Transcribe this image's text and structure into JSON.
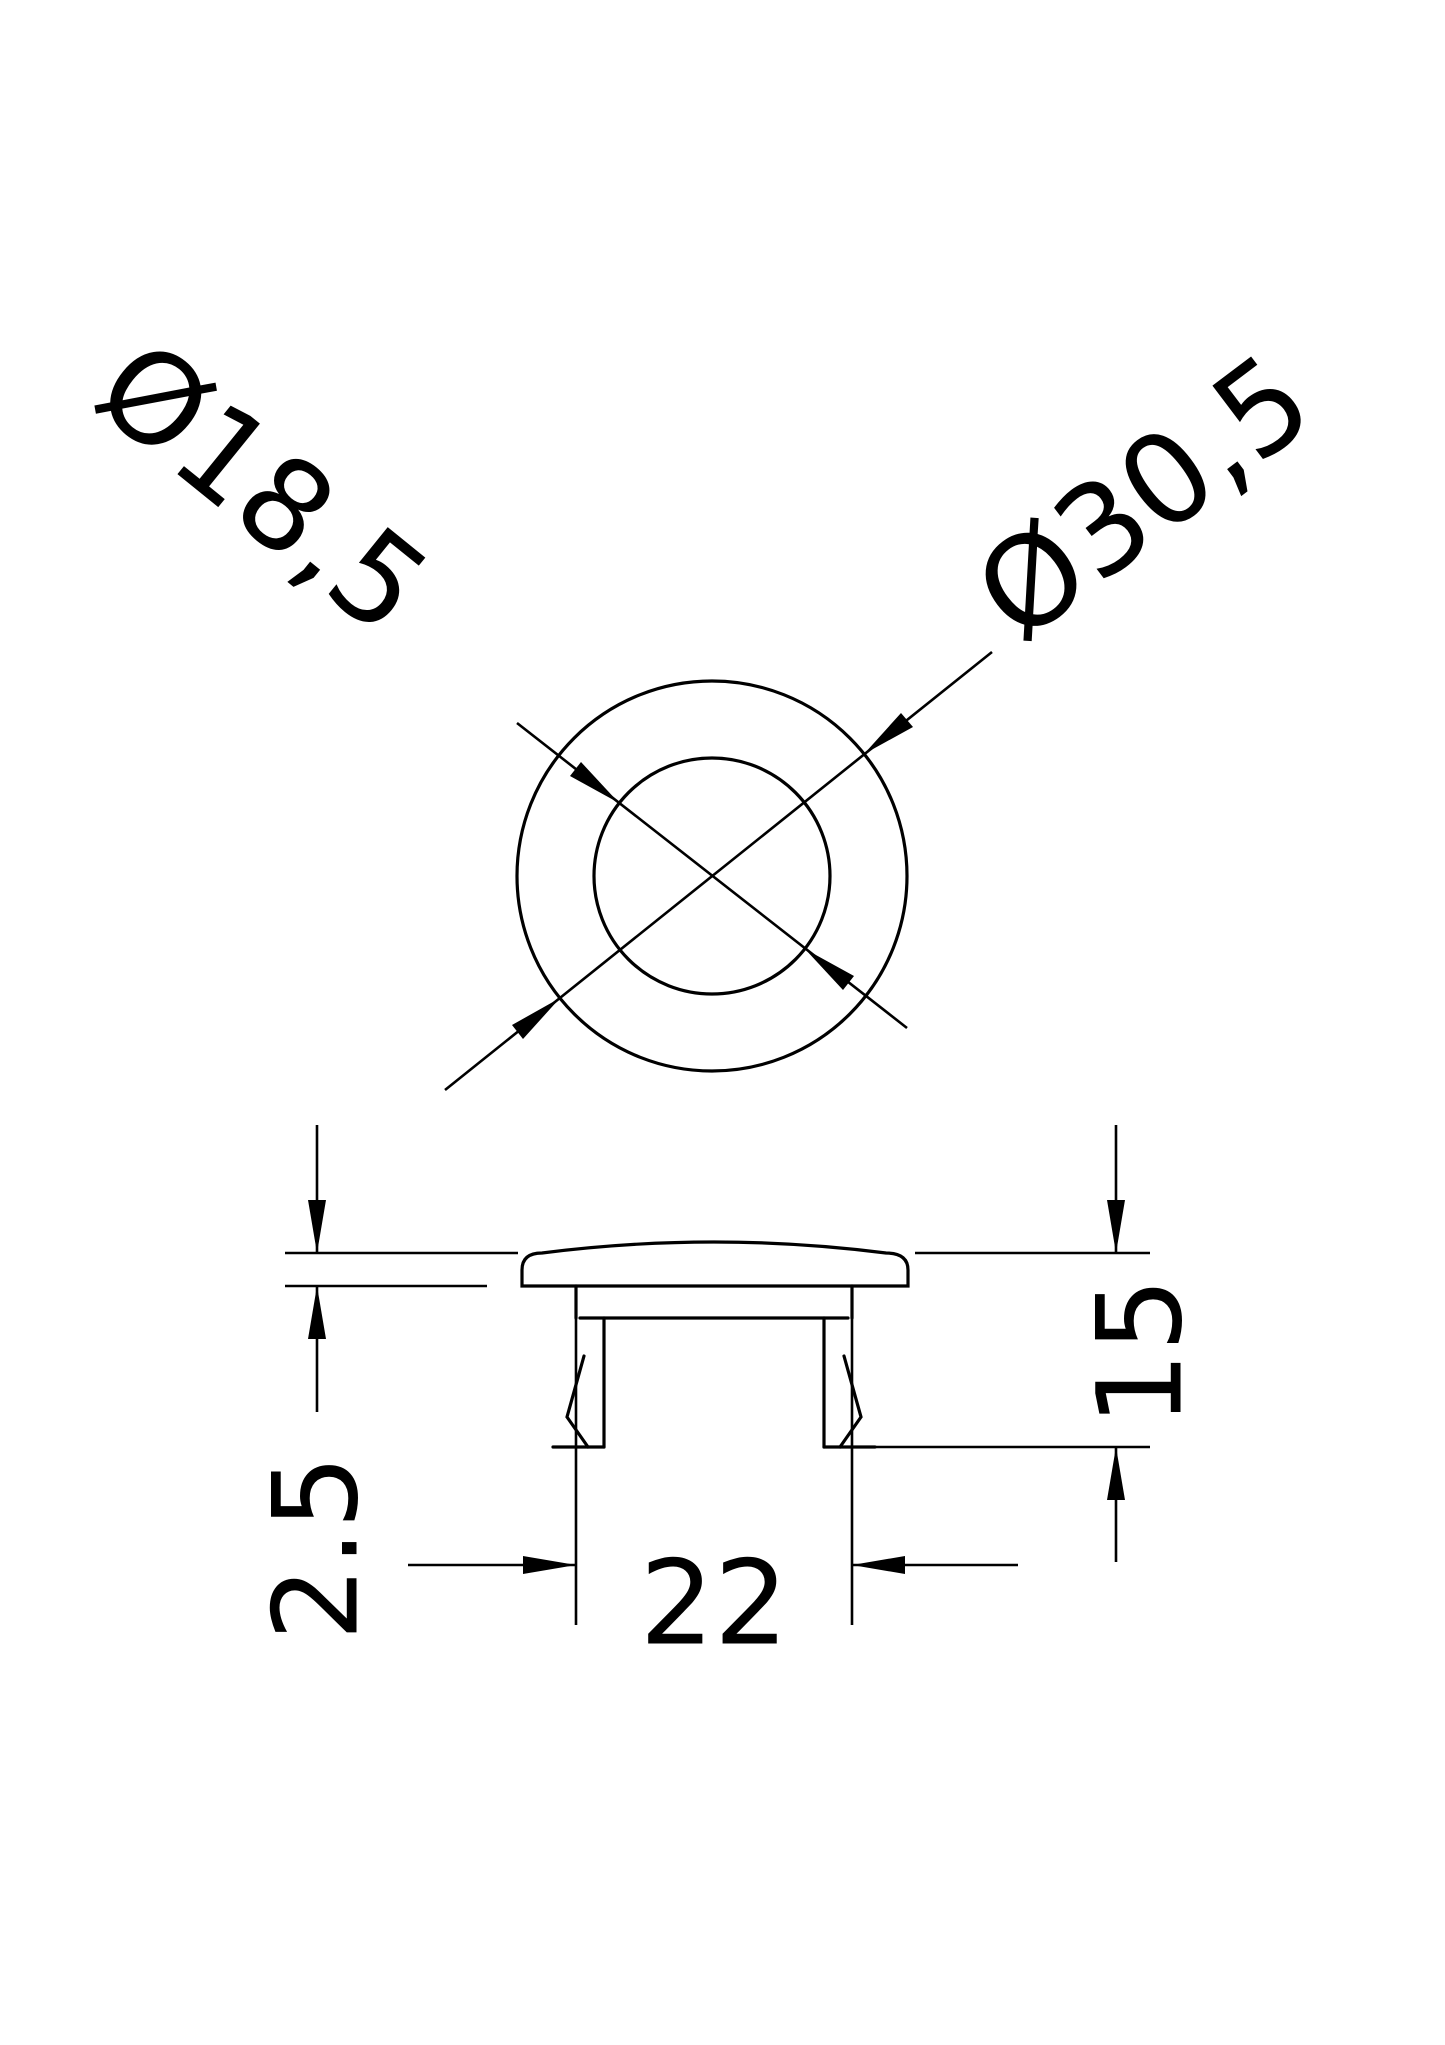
{
  "drawing": {
    "type": "technical-drawing",
    "views": {
      "top_view": {
        "inner_diameter_label": "Ø18,5",
        "outer_diameter_label": "Ø30,5"
      },
      "side_view": {
        "flange_thickness_label": "2.5",
        "height_label": "15",
        "width_label": "22"
      }
    },
    "colors": {
      "line": "#000000",
      "background": "#ffffff"
    }
  }
}
